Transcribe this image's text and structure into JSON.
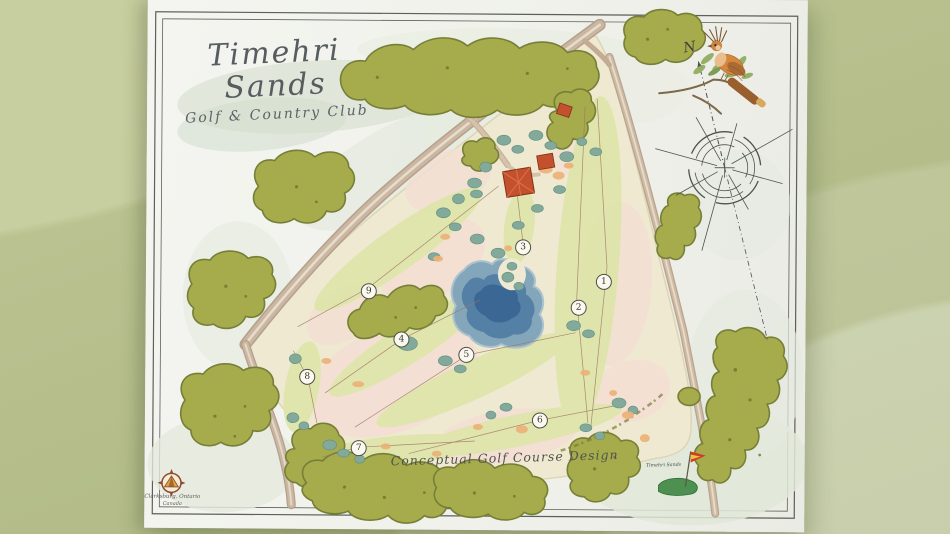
{
  "map": {
    "title": "Timehri Sands",
    "subtitle": "Golf & Country Club",
    "caption": "Conceptual Golf Course Design",
    "compass_north_label": "N",
    "holes": [
      "1",
      "2",
      "3",
      "4",
      "5",
      "6",
      "7",
      "8",
      "9"
    ],
    "designer_stamp": {
      "line1": "Clarksburg, Ontario",
      "line2": "Canada"
    },
    "club_marker_label": "Timehri Sands",
    "colors": {
      "background_sage": "#b5be8b",
      "paper": "#f1f2ec",
      "forest_green": "#a6ab4c",
      "fairway_green": "#dfe5ac",
      "sand_pink": "#f3ded3",
      "pond_blue": "#4f7ca3",
      "road_tan": "#c3ae97",
      "clubhouse_red": "#c4512e",
      "bush_teal": "#82a99a",
      "ink": "#4f524a"
    }
  }
}
